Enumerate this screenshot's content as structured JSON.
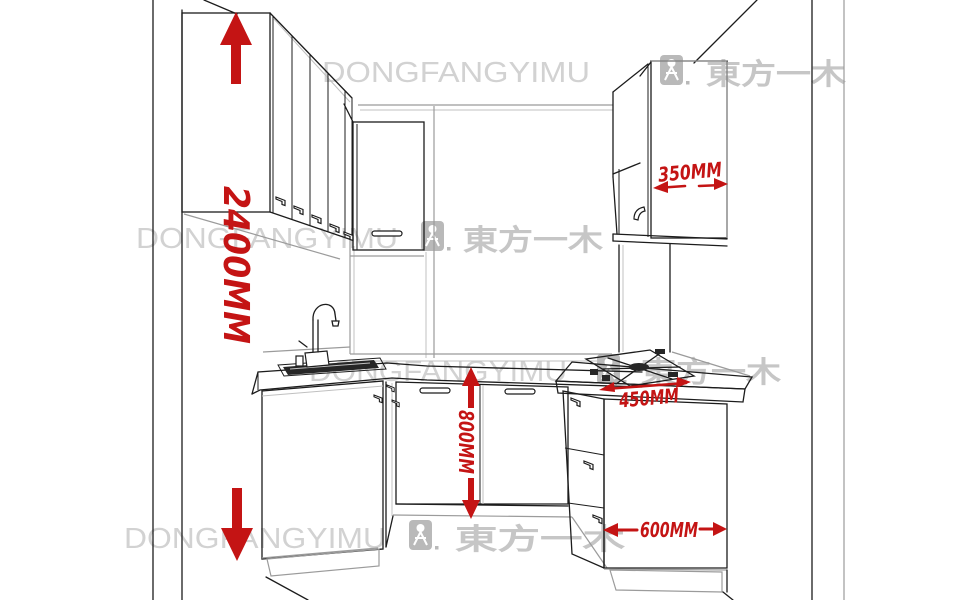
{
  "brand": {
    "watermark_text": "DONGFANGYIMU",
    "watermark_cjk": "東方一木"
  },
  "dimensions": {
    "ceiling_height": "2400MM",
    "wall_cabinet_width": "350MM",
    "base_cabinet_height": "800MM",
    "cooktop_section_width": "450MM",
    "base_cabinet_depth": "600MM"
  },
  "colors": {
    "dimension_red": "#c41414",
    "line_art": "#1c1c1c",
    "watermark_gray": "#d2d2d2",
    "watermark_cjk_gray": "#c6c6c6"
  }
}
